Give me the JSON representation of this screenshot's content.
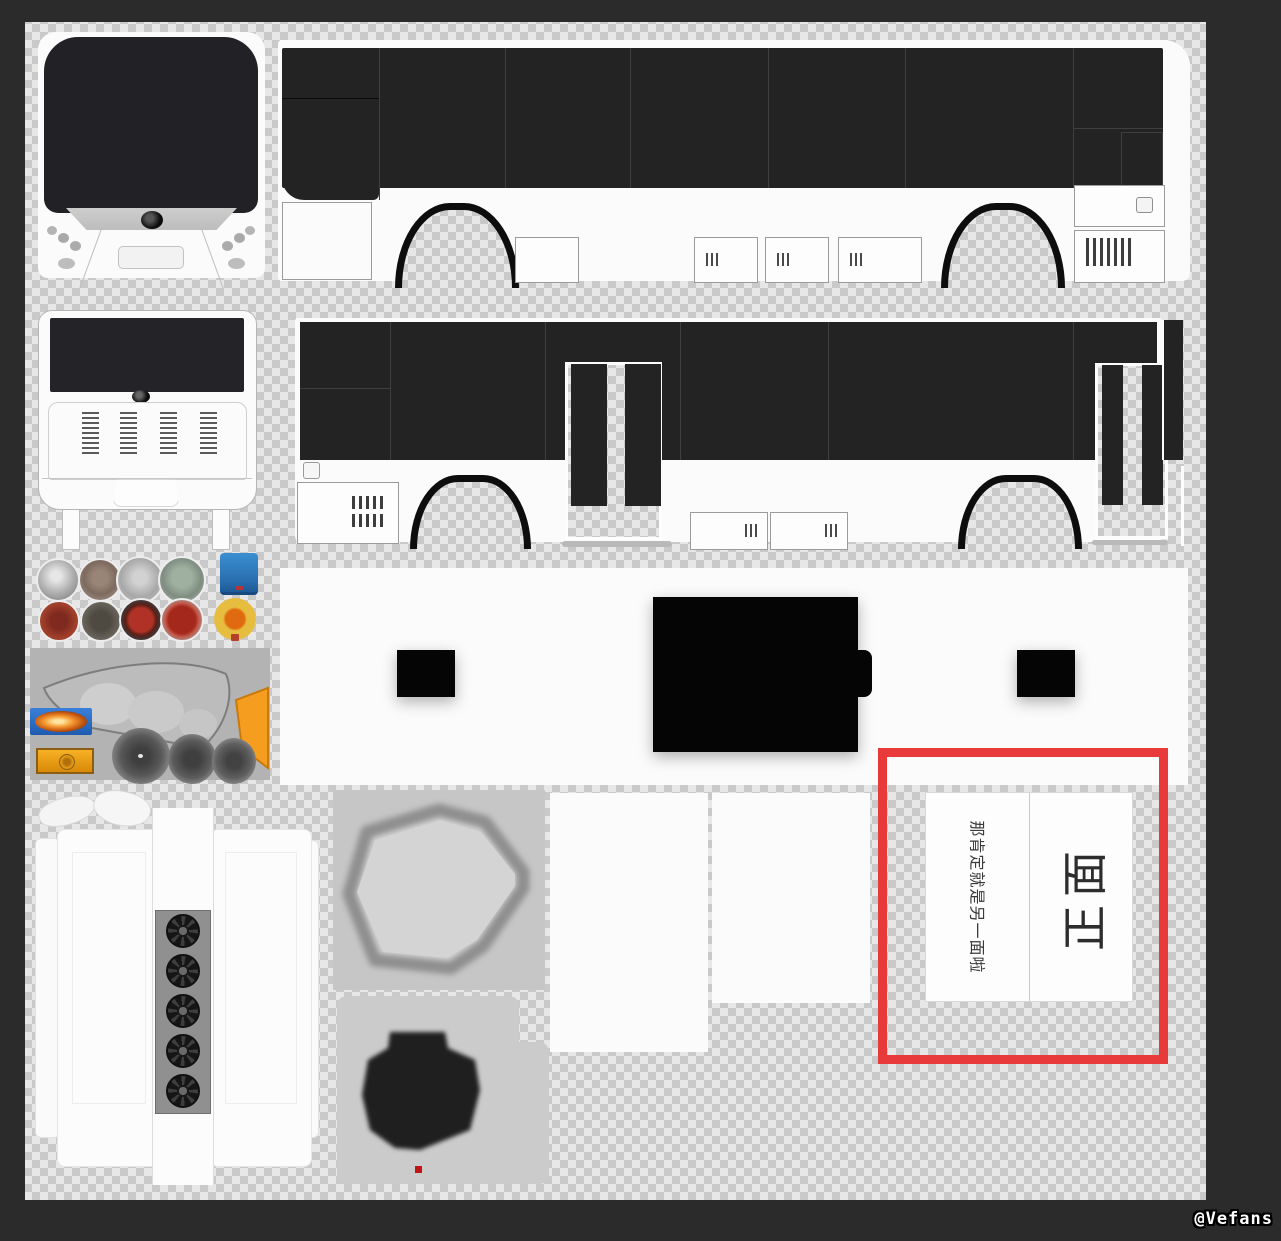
{
  "window": {
    "watermark": "@Vefans"
  },
  "annotation": {
    "label_small": "那肯定就是另一面啦",
    "label_large": "正面",
    "box_color": "#e8393b"
  },
  "palette": {
    "surround": "#2b2b2b",
    "checker_dark": "#c9c9c9",
    "checker_light": "#e7e7e7",
    "body_white": "#fbfbfb",
    "glass_black": "#232323",
    "texture_gray": "#b3b3b3",
    "fog_blue": "#2c6fd4",
    "signal_amber": "#f2a218",
    "button_yellow": "#e3bd45",
    "tail_red": "#a2402c",
    "seat_dark": "#222222",
    "marker_red": "#c21414"
  },
  "atlas": {
    "pieces": [
      {
        "name": "bus-front"
      },
      {
        "name": "bus-side-right"
      },
      {
        "name": "bus-rear"
      },
      {
        "name": "bus-side-left-with-doors"
      },
      {
        "name": "wheel-hubcaps"
      },
      {
        "name": "tail-lights"
      },
      {
        "name": "misc-blue-hatch"
      },
      {
        "name": "yellow-button"
      },
      {
        "name": "headlight-cluster"
      },
      {
        "name": "roof-strip-with-hatches"
      },
      {
        "name": "roof-ac-panels-with-fans"
      },
      {
        "name": "mirror-shells"
      },
      {
        "name": "seat-top"
      },
      {
        "name": "seat-back"
      },
      {
        "name": "blank-panel-left"
      },
      {
        "name": "blank-panel-right"
      },
      {
        "name": "label-sheet"
      }
    ]
  }
}
